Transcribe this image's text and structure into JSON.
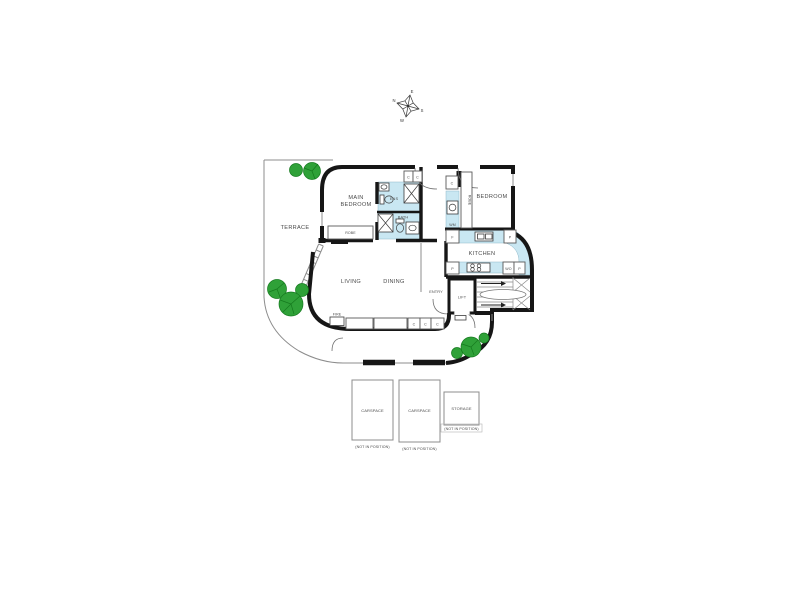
{
  "plan": {
    "type": "apartment-floor-plan",
    "compass": {
      "n": "N",
      "e": "E",
      "s": "S",
      "w": "W"
    },
    "rooms": {
      "terrace": "TERRACE",
      "main_bedroom_line1": "MAIN",
      "main_bedroom_line2": "BEDROOM",
      "ens": "ENS",
      "bath": "BATH",
      "bedroom": "BEDROOM",
      "kitchen": "KITCHEN",
      "living": "LIVING",
      "dining": "DINING",
      "entry": "ENTRY",
      "lift": "LIFT"
    },
    "fixtures": {
      "robe": "ROBE",
      "cupboard": "C",
      "fridge": "F",
      "pantry": "P",
      "wall_oven": "WO",
      "washing_machine": "WM",
      "fireplace": "FIRE"
    },
    "parking": {
      "carspace": "CARSPACE",
      "storage": "STORAGE",
      "note": "(NOT IN POSITION)"
    },
    "colors": {
      "wall": "#161616",
      "wet_area": "#c9e7f2",
      "tree": "#2fa138",
      "tree_edge": "#157a1e",
      "boundary": "#9a9a9a",
      "text": "#4a4a4a"
    }
  }
}
